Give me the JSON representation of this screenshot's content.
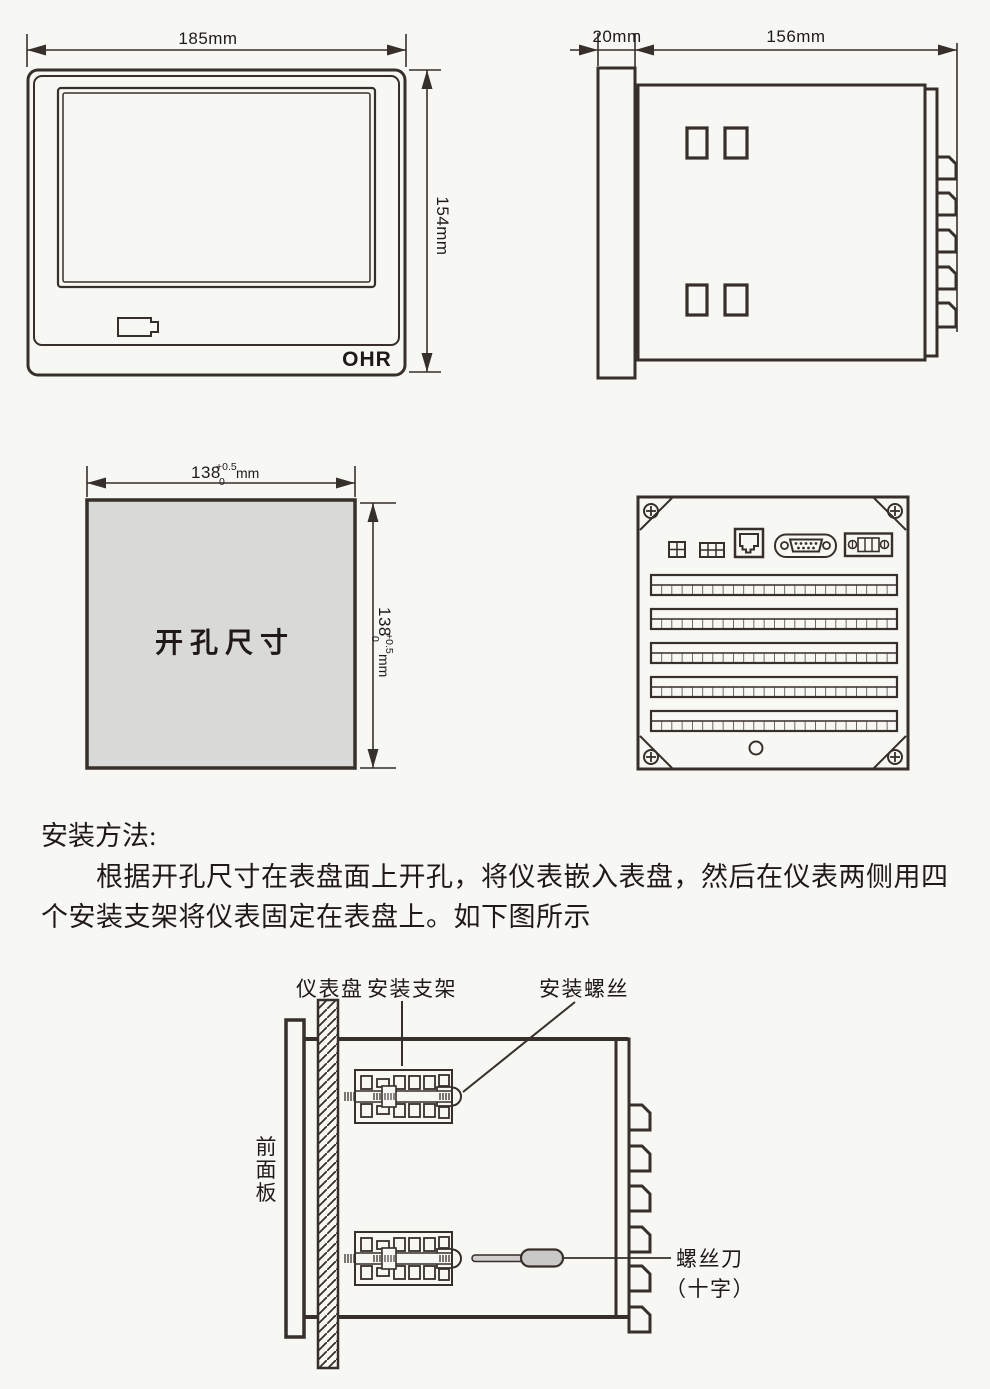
{
  "front_view": {
    "width_label": "185mm",
    "height_label": "154mm",
    "brand": "OHR"
  },
  "side_view": {
    "depth_label": "20mm",
    "body_label": "156mm"
  },
  "cutout": {
    "label": "开孔尺寸",
    "dim_base": "138",
    "dim_sup": "+0.5",
    "dim_sub": "0",
    "dim_unit": "mm"
  },
  "instructions": {
    "heading": "安装方法:",
    "line1": "根据开孔尺寸在表盘面上开孔，将仪表嵌入表盘，然后在仪表两侧用四",
    "line2": "个安装支架将仪表固定在表盘上。如下图所示"
  },
  "install": {
    "panel_label": "仪表盘",
    "bracket_label": "安装支架",
    "screw_label": "安装螺丝",
    "front_panel_label": "前面板",
    "screwdriver_label": "螺丝刀",
    "screwdriver_type": "（十字）"
  }
}
